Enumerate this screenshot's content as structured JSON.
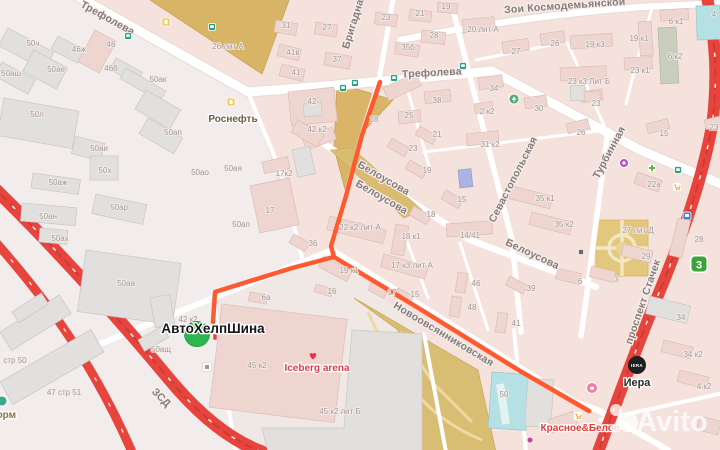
{
  "pois": {
    "rosneft": "Роснефть",
    "shop": "АвтоХелпШина",
    "iceberg": "Iceberg arena",
    "kb": "Красное&Белое",
    "iera_logo": "IERA",
    "iera": "Иера",
    "form": "форм",
    "badge3": "3",
    "watermark": "Avito"
  },
  "street_labels": [
    [
      "Трефолева",
      106,
      21,
      29
    ],
    [
      "Трефолева",
      432,
      76,
      -3
    ],
    [
      "Зои Космодемьянской",
      565,
      9,
      -4
    ],
    [
      "Бригадная",
      357,
      22,
      -73
    ],
    [
      "Белоусова",
      382,
      181,
      30
    ],
    [
      "Белоусова",
      380,
      200,
      30
    ],
    [
      "Белоусова",
      531,
      257,
      25
    ],
    [
      "Севастопольская",
      516,
      181,
      -63
    ],
    [
      "Турбинная",
      612,
      154,
      -62
    ],
    [
      "Новоовсянниковская",
      442,
      337,
      31
    ],
    [
      "проспект Стачек",
      646,
      303,
      -71,
      "#ffffff"
    ],
    [
      "ЗСД",
      159,
      400,
      45,
      "#ffffff",
      8.5
    ]
  ],
  "building_labels": [
    [
      "50ч",
      33,
      46
    ],
    [
      "46ж",
      79,
      52
    ],
    [
      "46",
      111,
      47
    ],
    [
      "46б",
      111,
      71
    ],
    [
      "50аш",
      11,
      76
    ],
    [
      "50ае",
      56,
      72
    ],
    [
      "50ак",
      158,
      82
    ],
    [
      "50л",
      37,
      117
    ],
    [
      "50ап",
      173,
      135
    ],
    [
      "50аи",
      99,
      151
    ],
    [
      "50х",
      105,
      173
    ],
    [
      "50аж",
      58,
      185
    ],
    [
      "50ан",
      48,
      219
    ],
    [
      "50ах",
      60,
      241
    ],
    [
      "50ар",
      119,
      210
    ],
    [
      "50аа",
      126,
      286
    ],
    [
      "50ао",
      200,
      175
    ],
    [
      "50ая",
      233,
      171
    ],
    [
      "50ап",
      241,
      227
    ],
    [
      "50ащ",
      161,
      352
    ],
    [
      "стр 50",
      15,
      363
    ],
    [
      "47 стр 51",
      64,
      395
    ],
    [
      "42",
      312,
      104
    ],
    [
      "42 к2",
      317,
      132
    ],
    [
      "28",
      374,
      122
    ],
    [
      "25",
      409,
      118
    ],
    [
      "38",
      437,
      103
    ],
    [
      "42 к2",
      188,
      322
    ],
    [
      "17к2",
      284,
      176
    ],
    [
      "17",
      270,
      213
    ],
    [
      "6а",
      266,
      300
    ],
    [
      "16",
      332,
      294
    ],
    [
      "36",
      313,
      246
    ],
    [
      "22 к2 лит А",
      360,
      230
    ],
    [
      "19 к1",
      349,
      273
    ],
    [
      "17 к3 лит А",
      412,
      268
    ],
    [
      "18 к1",
      411,
      239
    ],
    [
      "18",
      431,
      217
    ],
    [
      "15",
      462,
      202
    ],
    [
      "19",
      427,
      173
    ],
    [
      "23",
      413,
      151
    ],
    [
      "21",
      437,
      137
    ],
    [
      "31 к2",
      490,
      147
    ],
    [
      "31",
      286,
      28
    ],
    [
      "27",
      327,
      30
    ],
    [
      "23",
      386,
      20
    ],
    [
      "21",
      420,
      16
    ],
    [
      "19",
      446,
      9
    ],
    [
      "28",
      434,
      38
    ],
    [
      "35б",
      408,
      50
    ],
    [
      "37",
      337,
      62
    ],
    [
      "41в",
      293,
      55
    ],
    [
      "41",
      296,
      75
    ],
    [
      "26 лит А",
      228,
      49
    ],
    [
      "20 лит А",
      483,
      32
    ],
    [
      "27",
      516,
      54
    ],
    [
      "26",
      555,
      46
    ],
    [
      "34",
      494,
      91
    ],
    [
      "30",
      539,
      111
    ],
    [
      "23",
      596,
      106
    ],
    [
      "2 к2",
      487,
      114
    ],
    [
      "19 к3",
      595,
      47
    ],
    [
      "19 к1",
      639,
      41
    ],
    [
      "6 к1",
      676,
      24
    ],
    [
      "6 к2",
      675,
      59
    ],
    [
      "23 к1",
      640,
      73
    ],
    [
      "23 к3 Лит Б",
      589,
      84
    ],
    [
      "4",
      714,
      17
    ],
    [
      "26",
      581,
      135
    ],
    [
      "15",
      664,
      136
    ],
    [
      "23",
      714,
      130
    ],
    [
      "22а",
      654,
      187
    ],
    [
      "27 лит Д",
      638,
      233
    ],
    [
      "29",
      646,
      259
    ],
    [
      "28",
      699,
      242
    ],
    [
      "35 к1",
      545,
      201
    ],
    [
      "35 к2",
      564,
      227
    ],
    [
      "3",
      616,
      282
    ],
    [
      "6",
      580,
      284
    ],
    [
      "39",
      531,
      291
    ],
    [
      "34",
      681,
      320
    ],
    [
      "34 к2",
      693,
      357
    ],
    [
      "4 к2",
      704,
      389
    ],
    [
      "17",
      392,
      295
    ],
    [
      "15",
      415,
      297
    ],
    [
      "46",
      476,
      286
    ],
    [
      "48",
      472,
      310
    ],
    [
      "41",
      516,
      326
    ],
    [
      "45 к2",
      257,
      368
    ],
    [
      "45 к2 лит Б",
      340,
      414
    ],
    [
      "50",
      504,
      397
    ],
    [
      "14/41",
      470,
      238
    ]
  ]
}
